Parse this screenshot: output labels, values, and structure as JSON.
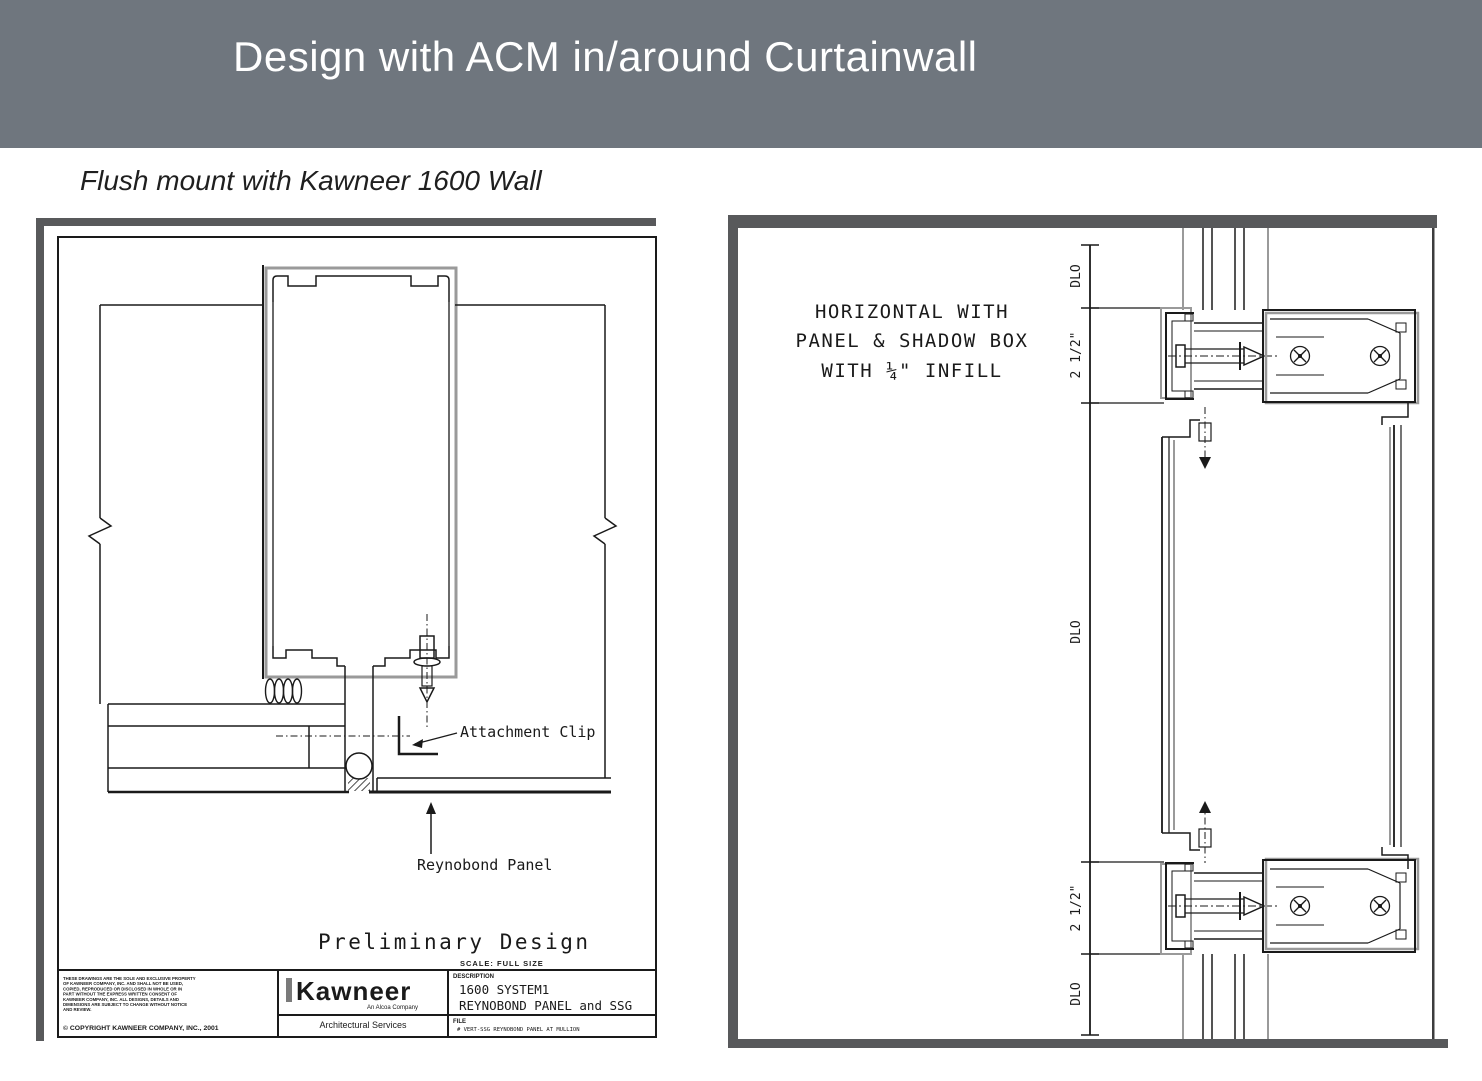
{
  "slide": {
    "title": "Design with ACM in/around Curtainwall",
    "subtitle": "Flush mount with Kawneer 1600 Wall"
  },
  "colors": {
    "header_bg": "#6F767E",
    "frame_gray": "#58595B",
    "line_black": "#1a1a1a",
    "shadow_gray": "#9a9a9a"
  },
  "left_drawing": {
    "labels": {
      "attachment_clip": "Attachment Clip",
      "reynobond_panel": "Reynobond Panel"
    },
    "title": "Preliminary Design",
    "scale_note": "SCALE: FULL SIZE",
    "title_block": {
      "disclaimer_lines": [
        "THESE DRAWINGS ARE THE SOLE AND EXCLUSIVE PROPERTY",
        "OF KAWNEER COMPANY, INC. AND SHALL NOT BE USED,",
        "COPIED, REPRODUCED OR DISCLOSED IN WHOLE OR IN",
        "PART WITHOUT THE EXPRESS WRITTEN CONSENT OF",
        "KAWNEER COMPANY, INC. ALL DESIGNS, DETAILS AND",
        "DIMENSIONS ARE SUBJECT TO CHANGE WITHOUT NOTICE",
        "AND REVIEW."
      ],
      "copyright": "© COPYRIGHT KAWNEER COMPANY, INC., 2001",
      "brand": "Kawneer",
      "brand_tagline": "An Alcoa Company",
      "brand_dept": "Architectural Services",
      "description_label": "DESCRIPTION",
      "description_line1": "1600 SYSTEM1",
      "description_line2": "REYNOBOND PANEL and SSG",
      "file_label": "FILE",
      "file_value": "# VERT-SSG REYNOBOND PANEL AT MULLION"
    }
  },
  "right_drawing": {
    "caption_line1": "HORIZONTAL WITH",
    "caption_line2": "PANEL & SHADOW BOX",
    "caption_line3": "WITH ¼\" INFILL",
    "dimensions": [
      "DLO",
      "2 1/2\"",
      "DLO",
      "2 1/2\"",
      "DLO"
    ]
  }
}
